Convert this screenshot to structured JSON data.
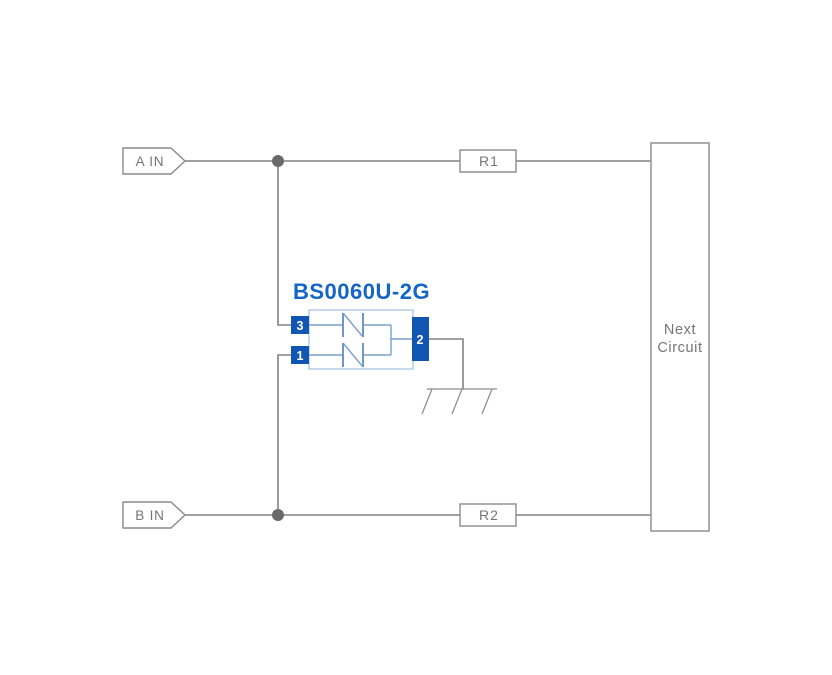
{
  "diagram": {
    "component": {
      "title": "BS0060U-2G",
      "pin_3": "3",
      "pin_1": "1",
      "pin_2": "2"
    },
    "ports": {
      "a_in": "A IN",
      "b_in": "B IN"
    },
    "resistors": {
      "r1": "R1",
      "r2": "R2"
    },
    "next_circuit": {
      "line_1": "Next",
      "line_2": "Circuit"
    },
    "icons": {
      "ground": "chassis-ground-icon",
      "junction": "junction-dot"
    }
  },
  "colors": {
    "background": "#ffffff",
    "wire_gray": "#828282",
    "outline_gray": "#8a8a8a",
    "label_gray": "#757575",
    "junction_gray": "#6a6a6a",
    "title_blue": "#1565c8",
    "pin_blue": "#1256b4",
    "component_outline_blue": "#a9c7e7",
    "element_blue": "#6f96cc"
  }
}
